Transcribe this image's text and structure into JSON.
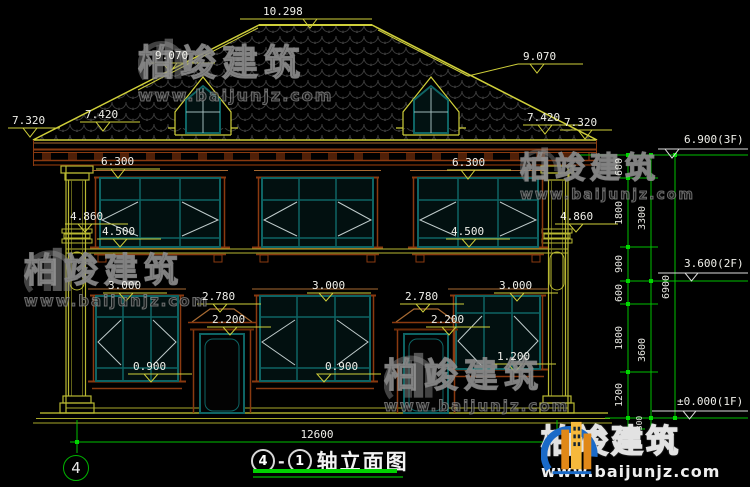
{
  "watermark": {
    "brand": "柏竣建筑",
    "url": "www.baijunjz.com"
  },
  "title": {
    "axis_from": "4",
    "dash": "-",
    "axis_to": "1",
    "name": "轴立面图"
  },
  "axis_bubble_left": "4",
  "dims": {
    "ridge": "10.298",
    "dormer_left": "9.070",
    "dormer_right": "9.070",
    "eave_outer_left": "7.320",
    "eave_inner_left": "7.420",
    "eave_inner_right": "7.420",
    "eave_outer_right": "7.320",
    "win2_head_left": "6.300",
    "win2_head_right": "6.300",
    "col_band_left": "4.860",
    "col_band_right": "4.860",
    "win2_sill_left": "4.500",
    "win2_sill_right": "4.500",
    "win1_head_left": "3.000",
    "win1_head_center": "3.000",
    "win1_head_right": "3.000",
    "door_ped_left": "2.780",
    "door_ped_right": "2.780",
    "door_head_left": "2.200",
    "door_head_right": "2.200",
    "win1_sill_left": "0.900",
    "win1_sill_center": "0.900",
    "win1_sill_right": "1.200",
    "total_width": "12600"
  },
  "floor_flags": {
    "f3": "6.900(3F)",
    "f2": "3.600(2F)",
    "f1": "±0.000(1F)"
  },
  "chain": {
    "inner": [
      "600",
      "1800",
      "900",
      "600",
      "1800",
      "1200"
    ],
    "base": "300",
    "mid": [
      "3300",
      "3600"
    ],
    "outer": "6900"
  },
  "colors": {
    "background": "#000000",
    "cad_yellow": "#cfcf3a",
    "trim_brown": "#8a3a10",
    "frame_teal": "#0e6464",
    "dim_green": "#00c000",
    "text_white": "#f0f0ea",
    "logo_blue": "#1a6ac8",
    "logo_orange": "#f0a020"
  }
}
